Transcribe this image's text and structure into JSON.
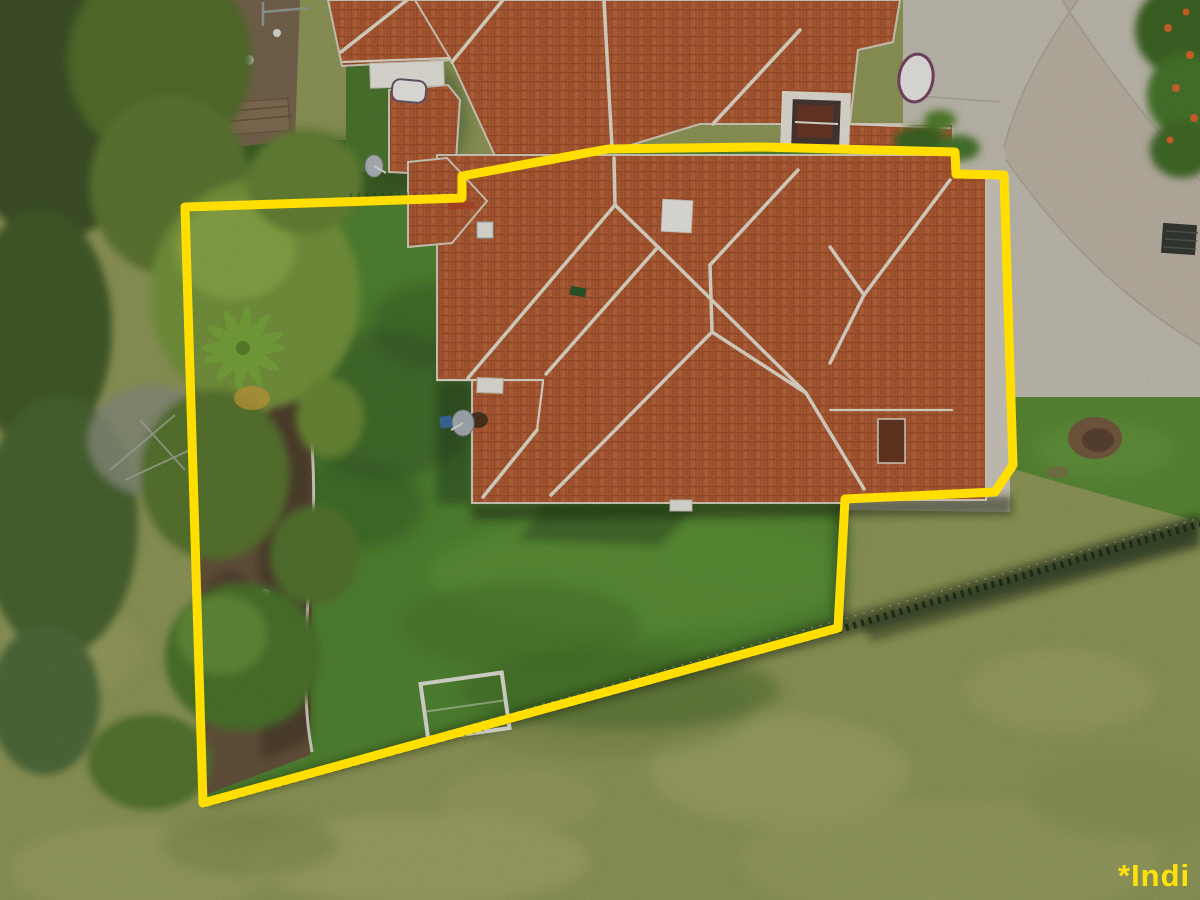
{
  "watermark": {
    "text": "*Indi"
  },
  "scene": {
    "description": "Aerial drone photo of a residential property with terracotta hip roofs, backyard lawn, trees on the left, concrete driveway top-right, and a yellow indicative boundary overlay",
    "boundary_points": "185,207 462,198 462,176 608,149 760,147 955,152 956,174 1004,175 1013,465 995,492 845,499 838,628 203,803",
    "colors": {
      "boundary": "#FFDE00",
      "watermark": "#FFE20A",
      "roof_tile": "#BC6338",
      "roof_tile_dark": "#A0502A",
      "roof_row": "#8E4526",
      "roof_ridge": "#ECE5D6",
      "roof_outline": "#DED7C8",
      "backyard": "#568C35",
      "field": "#97A05E",
      "neighbor_lawn": "#4F7C31",
      "right_grass": "#5F9038",
      "concrete": "#CDC7BA",
      "concrete_band": "#C4B9A9",
      "path": "#D8D2C6",
      "trees_dark": "#42562C",
      "trees_mid": "#5A742F",
      "trees_light": "#7C9C3F",
      "mulch": "#6A573F",
      "fence": "#1F2E18",
      "dirt": "#7D6A52"
    }
  }
}
